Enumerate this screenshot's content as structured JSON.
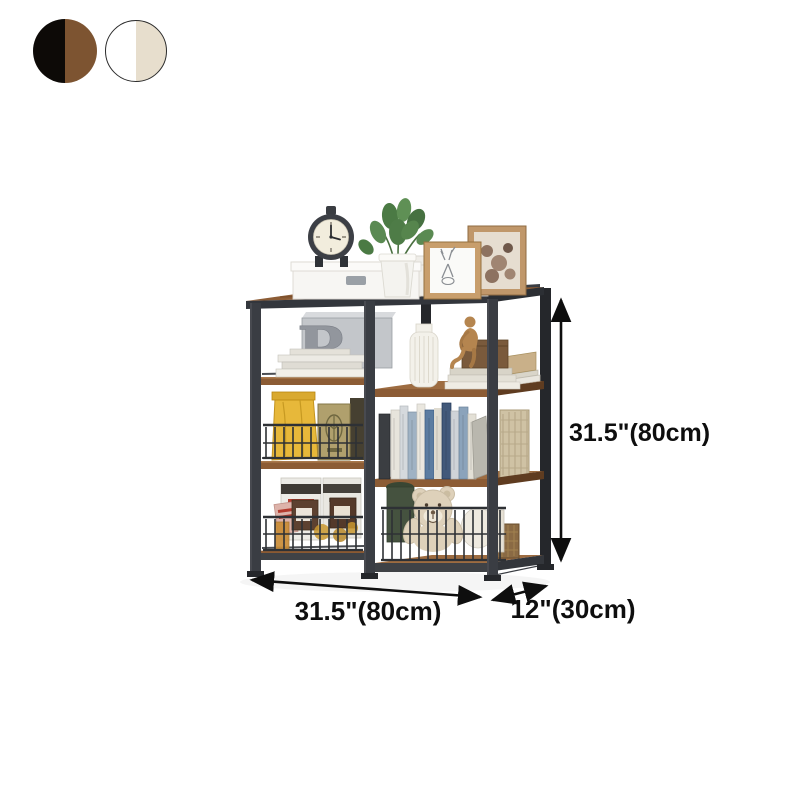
{
  "color_options": [
    {
      "label": "black-brown",
      "left_color": "#0d0a07",
      "right_color": "#7d5431",
      "border": "none"
    },
    {
      "label": "white-cream",
      "left_color": "#ffffff",
      "right_color": "#e7decd",
      "border": "#2b2b2b"
    }
  ],
  "dimensions": {
    "height_label": "31.5\"(80cm)",
    "width_label": "31.5\"(80cm)",
    "depth_label": "12\"(30cm)"
  },
  "decor": {
    "letter": "R"
  },
  "colors": {
    "ink": "#0e0e0e",
    "frame": "#3a3d43",
    "frame_dark": "#25272b",
    "wood": "#8c5c35",
    "wood_light": "#9d6c41",
    "wood_dark": "#5f3c20",
    "wire": "#2e3135",
    "metal_silver": "#c3c6ca",
    "accent_yellow": "#e7b83a",
    "plant_green": "#4e7c47",
    "bear_cream": "#ded1ba"
  }
}
